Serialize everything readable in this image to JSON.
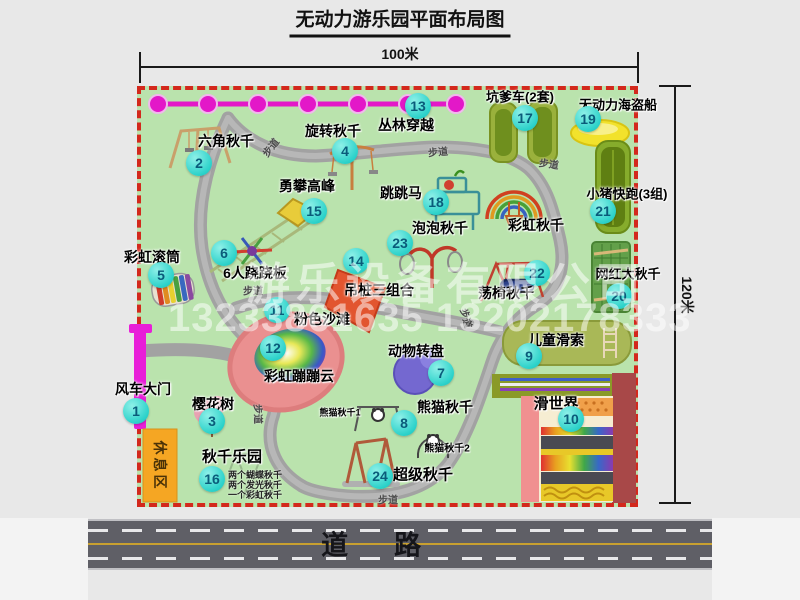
{
  "title": "无动力游乐园平面布局图",
  "dimensions": {
    "width_label": "100米",
    "height_label": "120米"
  },
  "road": {
    "label": "道路"
  },
  "watermark": {
    "company": "游乐设备有限公司",
    "phone": "13233861635 13202178333"
  },
  "path_label": "步道",
  "rest_area": "休息区",
  "extra_labels": {
    "rainbow_swing": "彩虹秋千",
    "panda_swing_1": "熊猫秋千1",
    "panda_swing_2": "熊猫秋千2"
  },
  "colors": {
    "map_green": "#bae3ad",
    "border_red": "#d3281c",
    "badge_cyan": "#2cd2ca",
    "gate_magenta": "#e81ed8",
    "zipline_magenta": "#e318c8",
    "rest_orange": "#f5a623",
    "road_gray": "#5f5f66"
  },
  "attractions": [
    {
      "num": "1",
      "name": "风车大门"
    },
    {
      "num": "2",
      "name": "六角秋千"
    },
    {
      "num": "3",
      "name": "樱花树"
    },
    {
      "num": "4",
      "name": "旋转秋千"
    },
    {
      "num": "5",
      "name": "彩虹滚筒"
    },
    {
      "num": "6",
      "name": "6人跷跷板"
    },
    {
      "num": "7",
      "name": "动物转盘"
    },
    {
      "num": "8",
      "name": "熊猫秋千"
    },
    {
      "num": "9",
      "name": "儿童滑索"
    },
    {
      "num": "10",
      "name": "滑世界"
    },
    {
      "num": "11",
      "name": "粉色沙滩"
    },
    {
      "num": "12",
      "name": "彩虹蹦蹦云"
    },
    {
      "num": "13",
      "name": "丛林穿越"
    },
    {
      "num": "14",
      "name": "吊桩三组合"
    },
    {
      "num": "15",
      "name": "勇攀高峰"
    },
    {
      "num": "16",
      "name": "秋千乐园",
      "notes": [
        "两个蝴蝶秋千",
        "两个发光秋千",
        "一个彩虹秋千"
      ]
    },
    {
      "num": "17",
      "name": "坑爹车(2套)"
    },
    {
      "num": "18",
      "name": "跳跳马"
    },
    {
      "num": "19",
      "name": "无动力海盗船"
    },
    {
      "num": "20",
      "name": "网红大秋千"
    },
    {
      "num": "21",
      "name": "小猪快跑(3组)"
    },
    {
      "num": "22",
      "name": "荡椅秋千"
    },
    {
      "num": "23",
      "name": "泡泡秋千"
    },
    {
      "num": "24",
      "name": "超级秋千"
    }
  ]
}
